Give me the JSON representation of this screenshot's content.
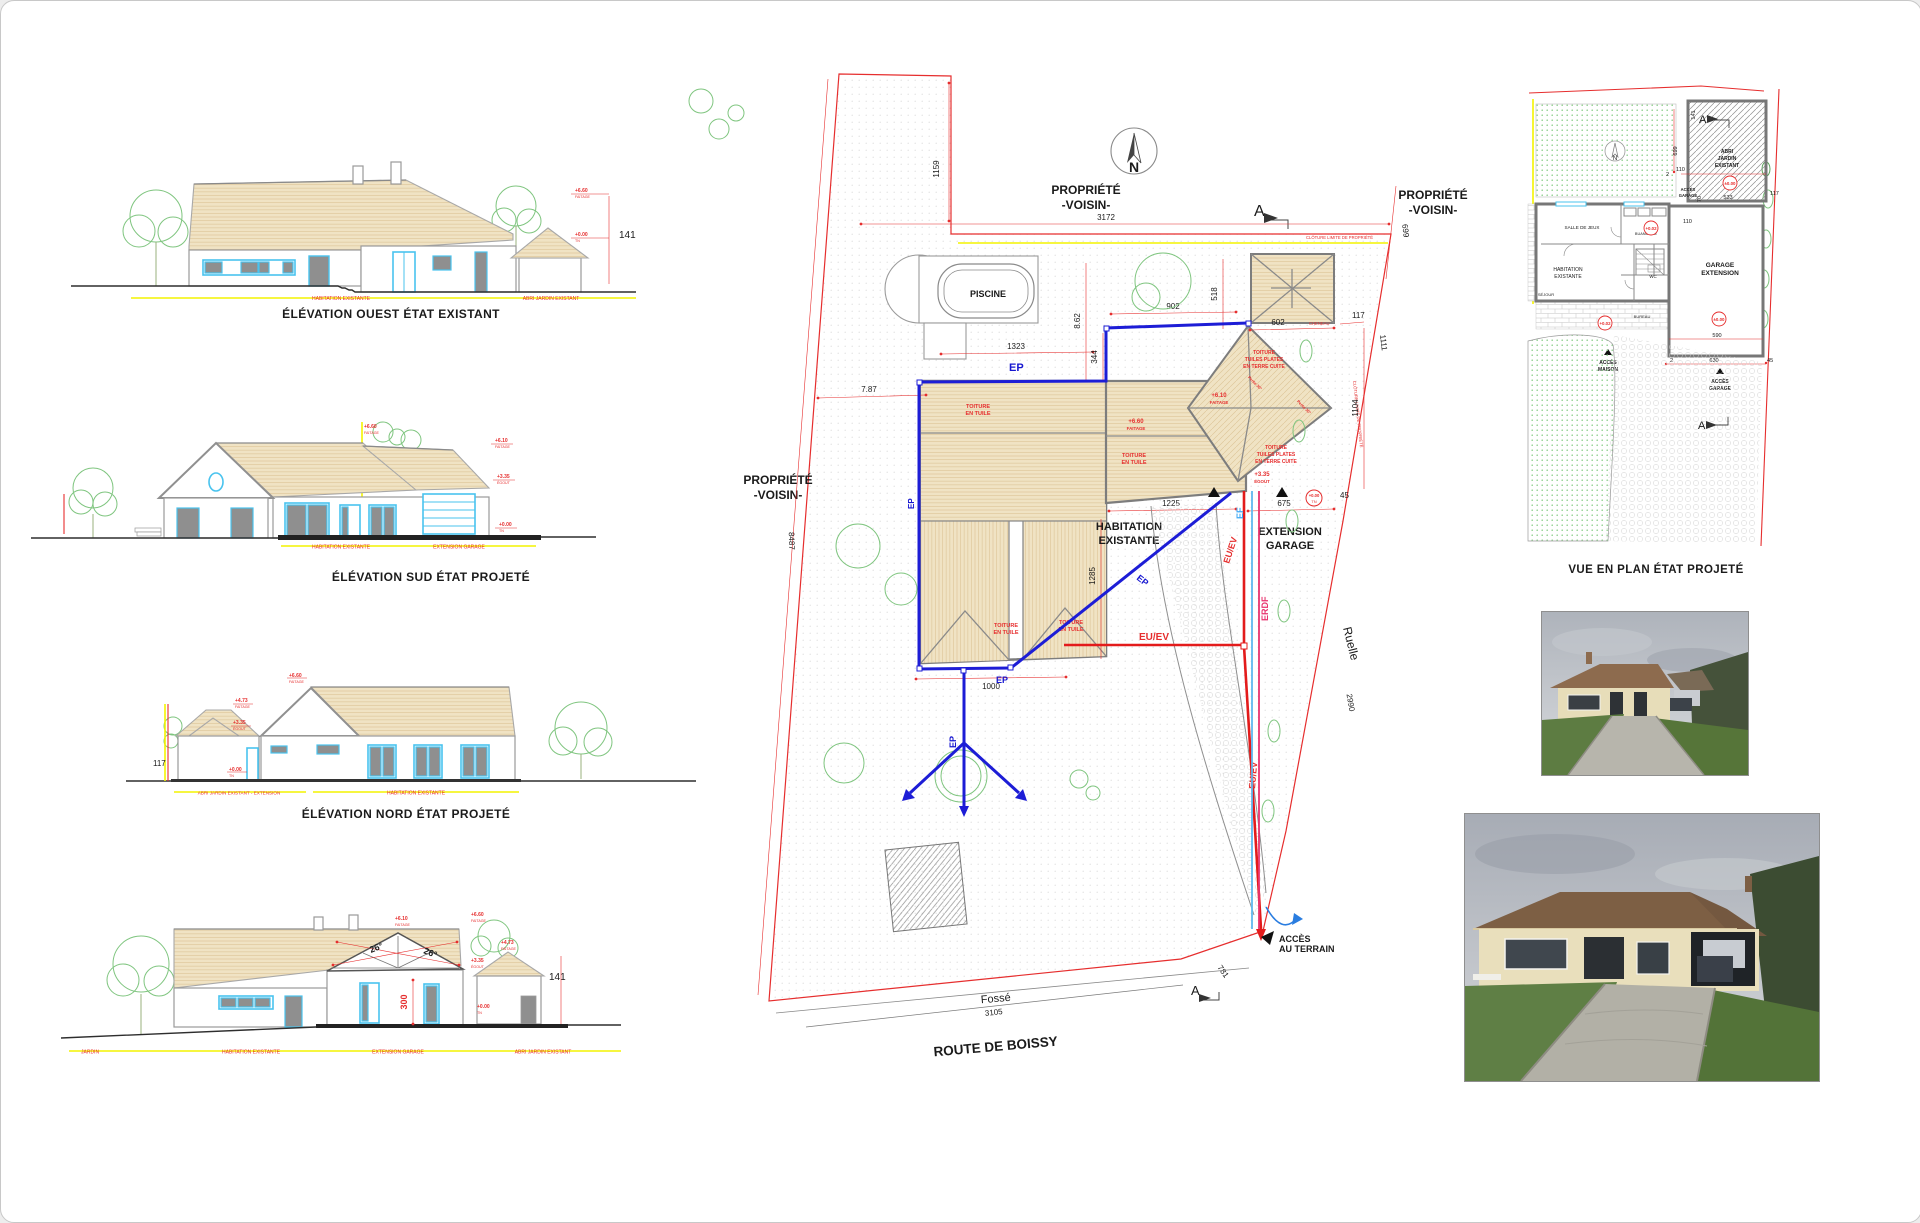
{
  "palette": {
    "accent_red": "#e62e2e",
    "pipe_blue": "#1d1dd6",
    "frame_cyan": "#49c3ee",
    "roof_beige": "#f0e3c4",
    "yellow": "#f3f300",
    "ef_blue": "#5fb8ef",
    "erdf_pink": "#e8336e",
    "tree_green": "#7fc57f"
  },
  "captions": {
    "west": "ÉLÉVATION OUEST ÉTAT EXISTANT",
    "south": "ÉLÉVATION SUD  ÉTAT PROJETÉ",
    "north": "ÉLÉVATION NORD  ÉTAT PROJETÉ",
    "plan": "VUE EN PLAN ÉTAT PROJETÉ"
  },
  "levels": {
    "f660": "+6.60",
    "f610": "+6.10",
    "f473": "+4.73",
    "e335": "+3.35",
    "z000": "+0.00",
    "faitage": "FAITAGE",
    "egout": "ÉGOUT",
    "tn": "TN"
  },
  "elev": {
    "jardin": "JARDIN",
    "habitation": "HABITATION EXISTANTE",
    "extension": "EXTENSION GARAGE",
    "abri": "ABRI JARDIN EXISTANT",
    "abri_ext": "ABRI JARDIN EXISTANT - EXTENSION",
    "d141": "141",
    "d117": "117",
    "d300": "300",
    "deg26": "26°"
  },
  "site": {
    "north": "N",
    "neighbor": [
      "PROPRIÉTÉ",
      "-VOISIN-"
    ],
    "piscine": "PISCINE",
    "habitation": [
      "HABITATION",
      "EXISTANTE"
    ],
    "extension": [
      "EXTENSION",
      "GARAGE"
    ],
    "toiture": [
      "TOITURE",
      "EN TUILE"
    ],
    "plates": [
      "TOITURE",
      "TUILES PLATES",
      "EN TERRE CUITE"
    ],
    "pente": "Pente 30°",
    "cheneau": "CHENEAU",
    "cloture": "CLÔTURE LIMITE DE PROPRIÉTÉ",
    "ep": "EP",
    "euev": "EU/EV",
    "ef": "EF",
    "erdf": "ERDF",
    "ruelle": "Ruelle",
    "fosse": "Fossé",
    "route": "ROUTE DE BOISSY",
    "acces_terrain": [
      "ACCÈS",
      "AU TERRAIN"
    ],
    "a": "A",
    "dims": {
      "d3172": "3172",
      "d1159": "1159",
      "d8487": "8487",
      "d787": "7.87",
      "d862": "8.62",
      "d1323": "1323",
      "d344": "344",
      "d902": "902",
      "d518": "518",
      "d602": "602",
      "d117": "117",
      "d1104": "1104",
      "d1111": "1111",
      "d699": "699",
      "d1225": "1225",
      "d675": "675",
      "d45": "45",
      "d1285": "1285",
      "d1000": "1000",
      "d2990": "2990",
      "d3105": "3105",
      "d781": "781"
    }
  },
  "plan": {
    "abri": [
      "ABRI",
      "JARDIN",
      "EXISTANT"
    ],
    "garage": [
      "GARAGE",
      "EXTENSION"
    ],
    "habitation": [
      "HABITATION",
      "EXISTANTE"
    ],
    "salle": "SALLE DE JEUX",
    "buanderie": "BUANDERIE",
    "sejour": "SÉJOUR",
    "bureau": "BUREAU",
    "wc": "WC",
    "acces_maison": [
      "ACCÈS",
      "MAISON"
    ],
    "acces_garage": [
      "ACCÈS",
      "GARAGE"
    ],
    "lvl_zero": "±0.00",
    "lvl_002": "+0.02",
    "a": "A",
    "n": "N",
    "dims": {
      "d141": "141",
      "d699": "699",
      "d2": "2",
      "d110": "110",
      "d533": "533",
      "d117": "117",
      "d70": "70",
      "d590": "590",
      "d630": "630",
      "d45": "45"
    }
  }
}
